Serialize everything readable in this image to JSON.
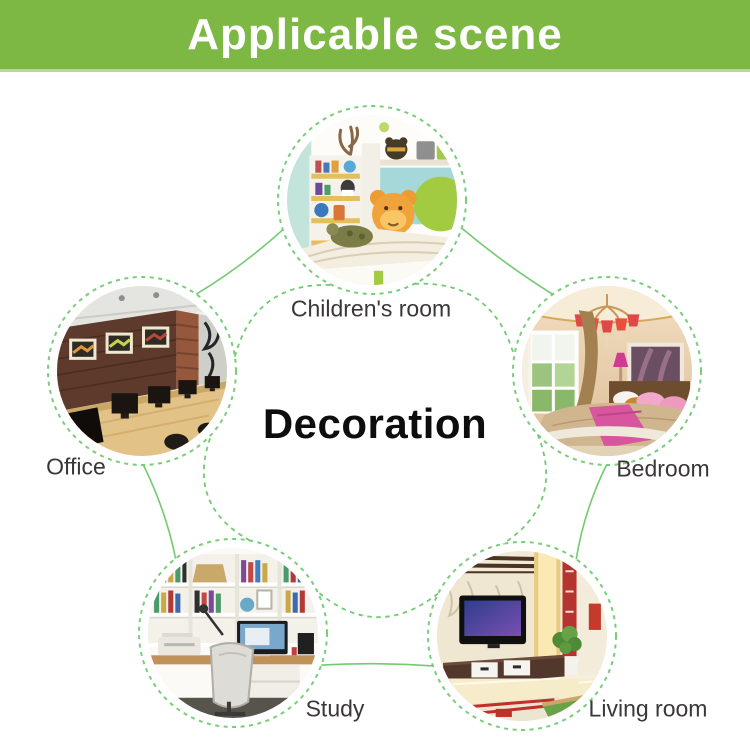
{
  "header": {
    "title": "Applicable scene"
  },
  "theme": {
    "banner_green": "#7cb843",
    "banner_edge": "#bcd795",
    "connector_green": "#72ca72",
    "label_color": "#3b3737",
    "center_text_color": "#0d0d0d"
  },
  "diagram": {
    "center_label": "Decoration",
    "center_label_x": 375,
    "center_label_y": 424,
    "center": {
      "x": 375,
      "y": 442
    },
    "radius": 85,
    "ring_radius": 94,
    "arc_geometry": {
      "solid_aim": 243,
      "solid_ctrl": 220,
      "dashed_aim": 120,
      "dashed_ctrl": 200
    },
    "scenes": [
      {
        "id": "childrens-room",
        "label": "Children's room",
        "cx": 372,
        "cy": 200,
        "label_x": 371,
        "label_y": 309
      },
      {
        "id": "bedroom",
        "label": "Bedroom",
        "cx": 607,
        "cy": 371,
        "label_x": 663,
        "label_y": 469
      },
      {
        "id": "living-room",
        "label": "Living room",
        "cx": 522,
        "cy": 636,
        "label_x": 648,
        "label_y": 709
      },
      {
        "id": "study",
        "label": "Study",
        "cx": 233,
        "cy": 633,
        "label_x": 335,
        "label_y": 709
      },
      {
        "id": "office",
        "label": "Office",
        "cx": 142,
        "cy": 371,
        "label_x": 76,
        "label_y": 467
      }
    ]
  }
}
